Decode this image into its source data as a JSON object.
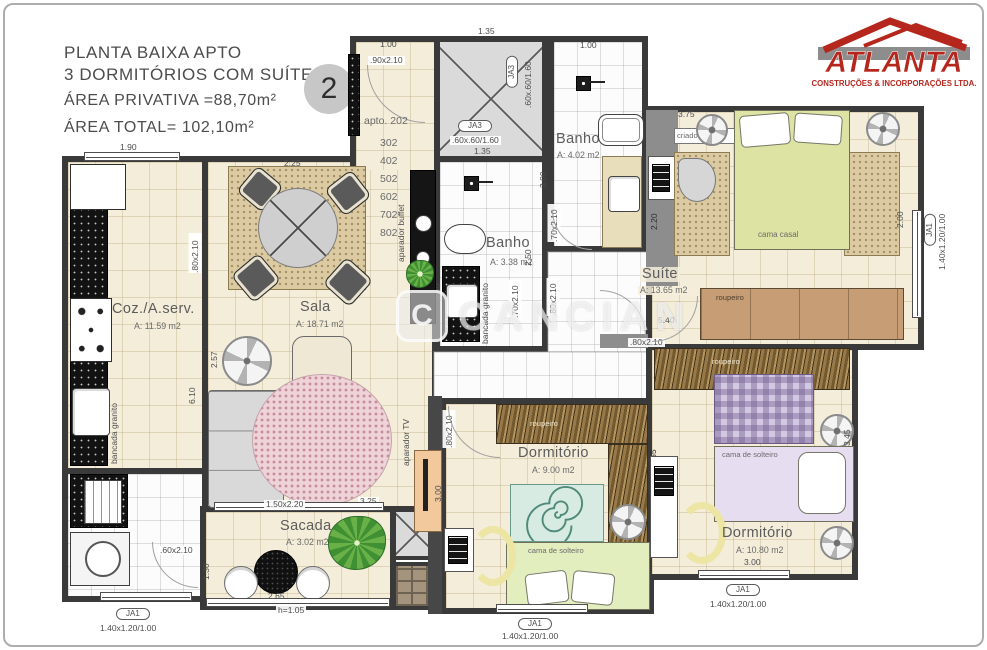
{
  "header": {
    "title_line1": "PLANTA BAIXA APTO",
    "title_line2": "3 DORMITÓRIOS COM SUÍTE",
    "area_privativa": "ÁREA PRIVATIVA =88,70m²",
    "area_total": "ÁREA TOTAL= 102,10m²",
    "unit_badge": "2"
  },
  "logo": {
    "brand": "ATLANTA",
    "subtitle": "CONSTRUÇÕES & INCORPORAÇÕES LTDA.",
    "brand_color": "#b5271d"
  },
  "watermark": {
    "text": "CANCIAN",
    "initial": "C"
  },
  "entry": {
    "apto_line": "apto. 202",
    "floors": [
      "302",
      "402",
      "502",
      "602",
      "702",
      "802"
    ]
  },
  "rooms": {
    "coz": {
      "name": "Coz./A.serv.",
      "area": "A: 11.59 m2"
    },
    "sala": {
      "name": "Sala",
      "area": "A: 18.71 m2"
    },
    "banho_meio": {
      "name": "Banho",
      "area": "A: 3.38 m2"
    },
    "banho_suite": {
      "name": "Banho",
      "area": "A: 4.02 m2"
    },
    "suite": {
      "name": "Suíte",
      "area": "A: 13.65 m2"
    },
    "dorm_meio": {
      "name": "Dormitório",
      "area": "A: 9.00 m2"
    },
    "dorm_dir": {
      "name": "Dormitório",
      "area": "A: 10.80 m2"
    },
    "sacada": {
      "name": "Sacada",
      "area": "A: 3.02 m2"
    }
  },
  "furniture": {
    "cama_casal": "cama casal",
    "cama_solteiro": "cama de solteiro",
    "roupeiro": "roupeiro",
    "criado_mudo": "criado-mudo",
    "aparador_buffet": "aparador buffet",
    "aparador_tv": "aparador TV",
    "bancada_granito": "bancada granito"
  },
  "openings": {
    "ja1": "JA1",
    "ja1_size": "1.40x1.20/1.00",
    "ja3": "JA3",
    "ja3_size": ".60x.60/1.60",
    "door_90": ".90x2.10",
    "door_80": ".80x2.10",
    "door_70": ".70x2.10",
    "door_60": ".60x2.10",
    "porta_sacada": "1.50x2.20",
    "guarda_corpo": "h=1.05"
  },
  "dims": {
    "d190": "1.90",
    "d100": "1.00",
    "d135": "1.35",
    "d225": "2.25",
    "d375": "3.75",
    "d540": "5.40",
    "d220": "2.20",
    "d200": "2.00",
    "d300": "3.00",
    "d250": "2.50",
    "d610": "6.10",
    "d257": "2.57",
    "d430": "4.30",
    "d325": "3.25",
    "d255": "2.55",
    "d345": "3.45",
    "d265": "2.65",
    "d130": "1.30"
  }
}
